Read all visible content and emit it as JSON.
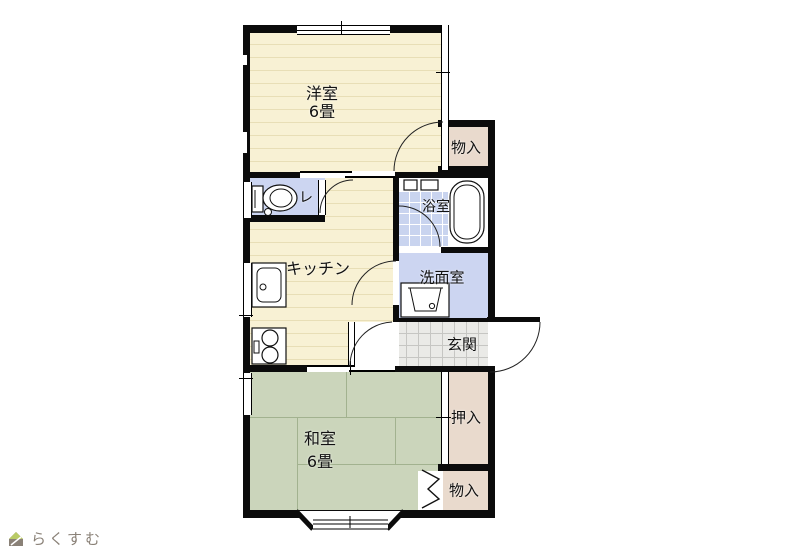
{
  "plan": {
    "type": "floor-plan",
    "rooms": {
      "western_room": {
        "label": "洋室",
        "size": "6畳"
      },
      "japanese_room": {
        "label": "和室",
        "size": "6畳"
      },
      "kitchen": {
        "label": "キッチン"
      },
      "toilet": {
        "label": "レ"
      },
      "bathroom": {
        "label": "浴室"
      },
      "washroom": {
        "label": "洗面室"
      },
      "entrance": {
        "label": "玄関"
      },
      "storage_upper": {
        "label": "物入"
      },
      "storage_lower": {
        "label": "物入"
      },
      "closet": {
        "label": "押入"
      }
    },
    "colors": {
      "flooring_cream": "#f8f1d4",
      "tatami_green": "#cbd5bb",
      "wet_area_blue": "#ccd5f1",
      "storage_pink": "#e9dacd",
      "entrance_gray": "#eaeae7",
      "wall_black": "#0b0b0b",
      "logo_green": "#b9cb66",
      "logo_gray": "#8a8177"
    }
  },
  "branding": {
    "logo_text": "らくすむ"
  }
}
